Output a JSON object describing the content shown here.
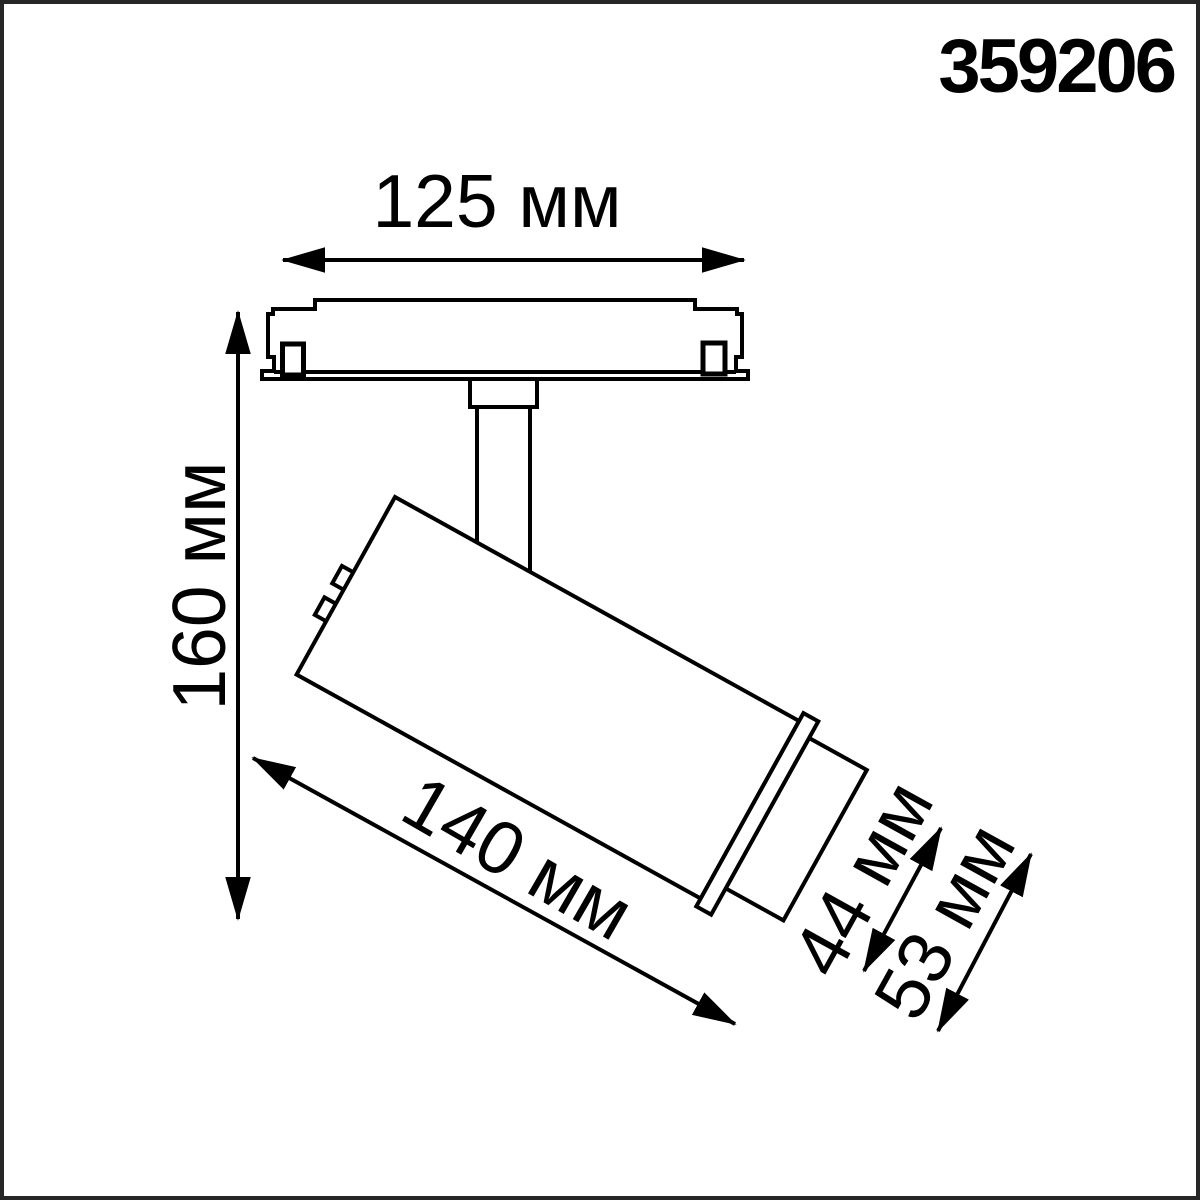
{
  "product_code": "359206",
  "drawing": {
    "description": "Side-view technical dimension drawing of a track-mounted spotlight",
    "dimensions": {
      "track_adapter_length": "125 мм",
      "overall_height": "160 мм",
      "body_length": "140 мм",
      "head_diameter": "44 мм",
      "body_diameter": "53 мм"
    }
  },
  "colors": {
    "line": "#000000",
    "background": "#ffffff",
    "frame_border": "#262626"
  }
}
